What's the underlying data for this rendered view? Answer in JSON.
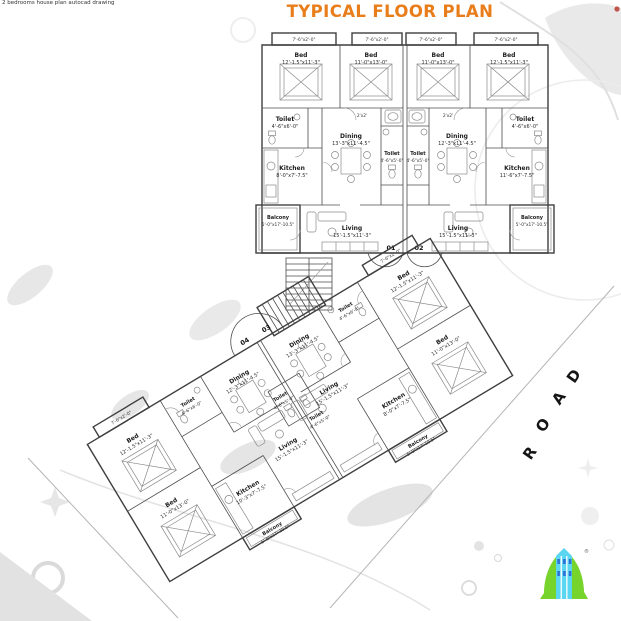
{
  "meta": {
    "title": "TYPICAL FLOOR PLAN",
    "watermark": "2 bedrooms house plan autocad drawing",
    "registered_mark": "®"
  },
  "road": {
    "letters": [
      "R",
      "O",
      "A",
      "D"
    ]
  },
  "colors": {
    "title_orange": "#E87D1A",
    "plan_line": "#3F3F3F",
    "road_text": "#151515",
    "logo_green": "#76D42C",
    "logo_cyan": "#5BD6F0",
    "logo_window_blue": "#2E6FD8",
    "decor_gray": "#E6E6E6"
  },
  "top_building": {
    "unit_left_no": "01",
    "unit_right_no": "02",
    "closet_tag": "7'-6\"x2'-0\"",
    "duct_tag": "2'x2'",
    "rooms": {
      "bedL1": {
        "n": "Bed",
        "d": "12'-1.5\"x11'-3\""
      },
      "bedL2": {
        "n": "Bed",
        "d": "11'-0\"x13'-0\""
      },
      "bedR1": {
        "n": "Bed",
        "d": "11'-0\"x13'-0\""
      },
      "bedR2": {
        "n": "Bed",
        "d": "12'-1.5\"x11'-3\""
      },
      "toiletL": {
        "n": "Toilet",
        "d": "4'-6\"x6'-0\""
      },
      "toiletR": {
        "n": "Toilet",
        "d": "4'-6\"x6'-0\""
      },
      "toiletCL": {
        "n": "Toilet",
        "d": "4'-6\"x5'-0\""
      },
      "toiletCR": {
        "n": "Toilet",
        "d": "4'-6\"x5'-0\""
      },
      "kitchenL": {
        "n": "Kitchen",
        "d": "8'-0\"x7'-7.5\""
      },
      "kitchenR": {
        "n": "Kitchen",
        "d": "11'-6\"x7'-7.5\""
      },
      "diningL": {
        "n": "Dining",
        "d": "13'-3\"x11'-4.5\""
      },
      "diningR": {
        "n": "Dining",
        "d": "12'-3\"x11'-4.5\""
      },
      "livingL": {
        "n": "Living",
        "d": "15'-1.5\"x11'-3\""
      },
      "livingR": {
        "n": "Living",
        "d": "15'-1.5\"x11'-3\""
      },
      "balconyL": {
        "n": "Balcony",
        "d": "5'-0\"x17'-10.5\""
      },
      "balconyR": {
        "n": "Balcony",
        "d": "5'-0\"x17'-10.5\""
      }
    }
  },
  "bottom_building": {
    "unit_left_no": "04",
    "unit_right_no": "03",
    "closet_tag": "7'-6\"x2'-0\"",
    "rooms": {
      "bedA": {
        "n": "Bed",
        "d": "12'-1.5\"x11'-3\""
      },
      "bedB": {
        "n": "Bed",
        "d": "11'-0\"x13'-0\""
      },
      "bedC": {
        "n": "Bed",
        "d": "12'-1.5\"x11'-3\""
      },
      "bedD": {
        "n": "Bed",
        "d": "11'-0\"x13'-0\""
      },
      "toiletA": {
        "n": "Toilet",
        "d": "4'-6\"x6'-0\""
      },
      "toiletB": {
        "n": "Toilet",
        "d": "4'-6\"x6'-0\""
      },
      "toiletCA": {
        "n": "Toilet",
        "d": "4'-6\"x5'-0\""
      },
      "toiletCB": {
        "n": "Toilet",
        "d": "4'-6\"x5'-0\""
      },
      "kitchenA": {
        "n": "Kitchen",
        "d": "10'-3\"x7'-7.5\""
      },
      "kitchenB": {
        "n": "Kitchen",
        "d": "8'-0\"x7'-7.5\""
      },
      "diningA": {
        "n": "Dining",
        "d": "12'-3\"x11'-4.5\""
      },
      "diningB": {
        "n": "Dining",
        "d": "13'-3\"x11'-4.5\""
      },
      "livingA": {
        "n": "Living",
        "d": "15'-1.5\"x11'-3\""
      },
      "livingB": {
        "n": "Living",
        "d": "15'-1.5\"x11'-3\""
      },
      "balconyA": {
        "n": "Balcony",
        "d": "5'-0\"x17'-10.5\""
      },
      "balconyB": {
        "n": "Balcony",
        "d": "5'-0\"x17'-10.5\""
      }
    }
  }
}
